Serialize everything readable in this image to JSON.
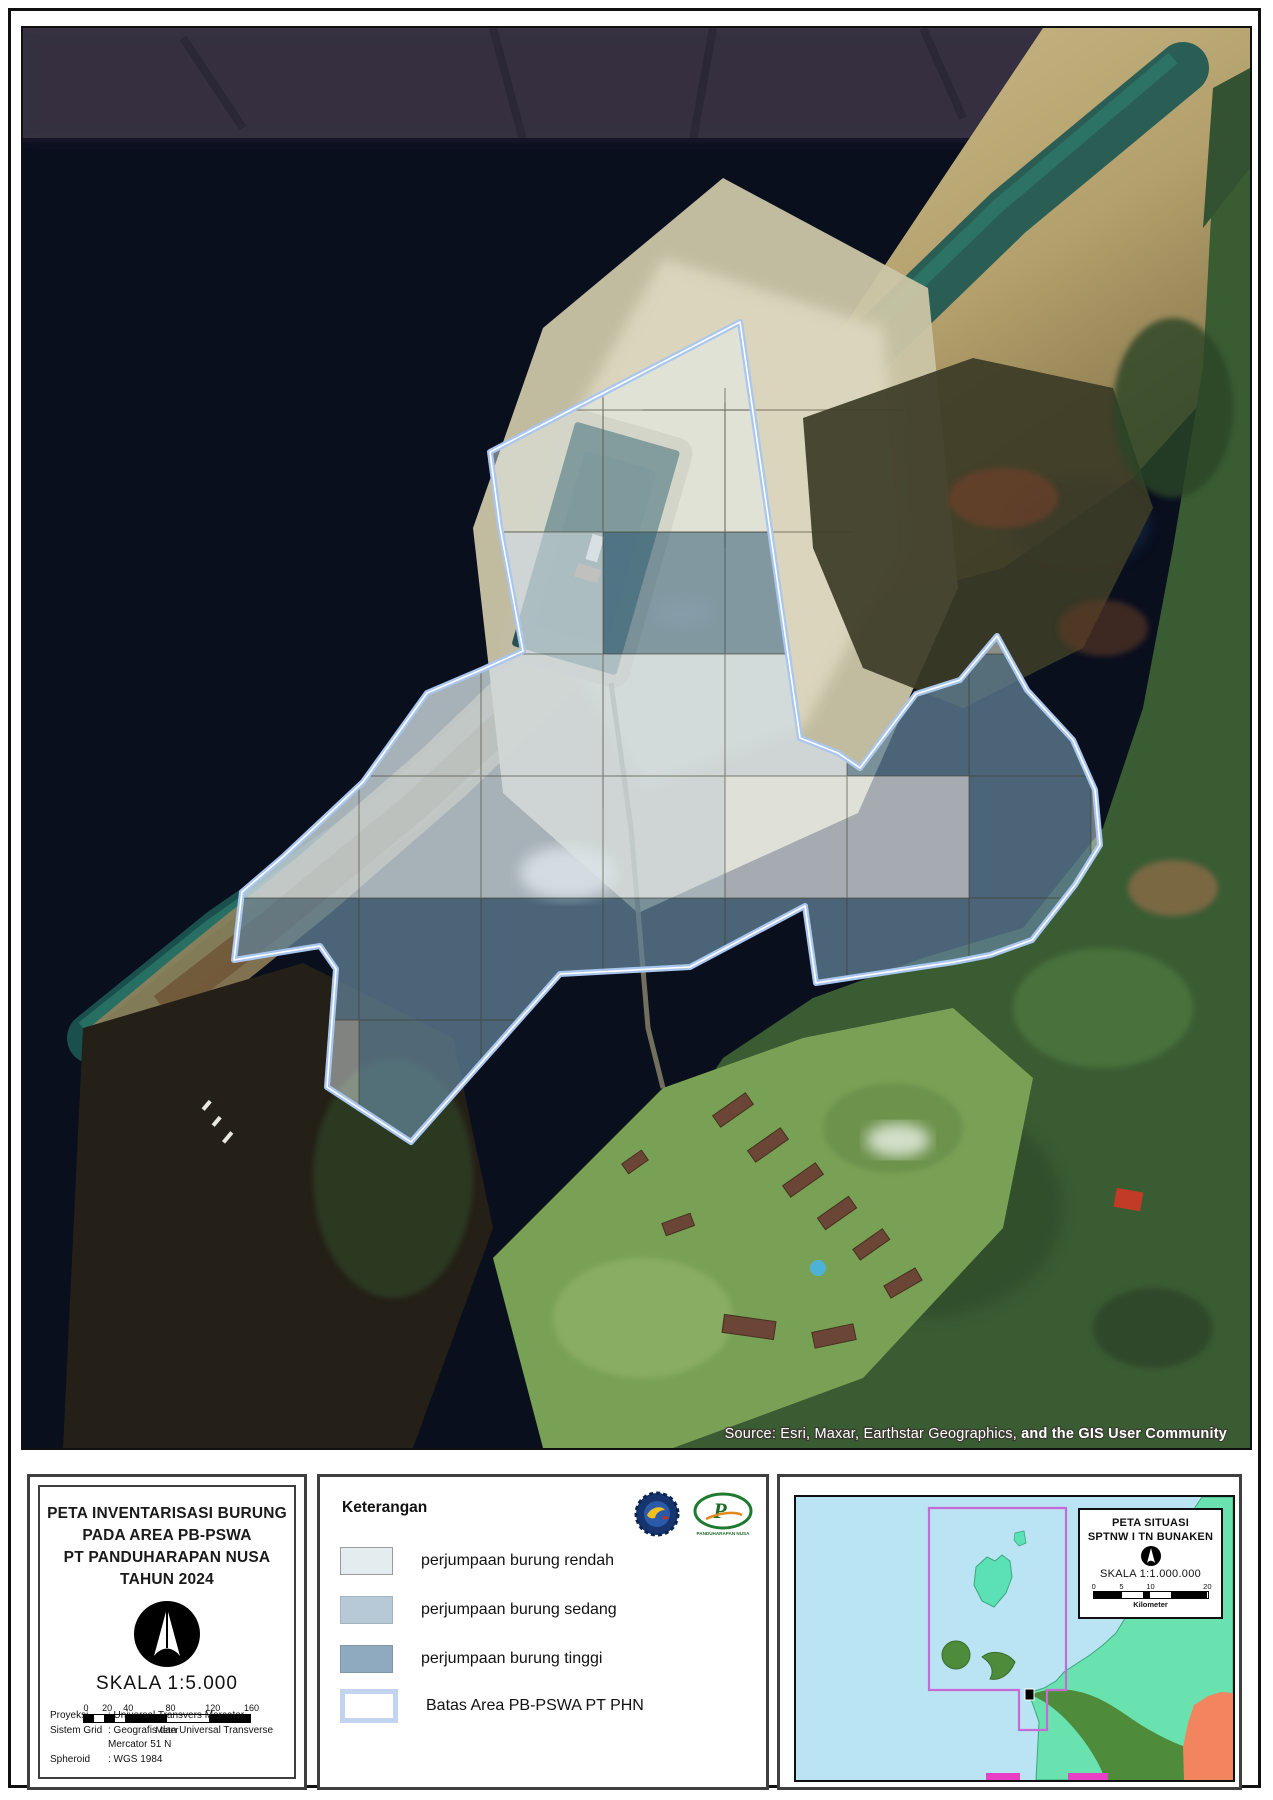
{
  "map": {
    "source_attribution": {
      "regular": "Source: Esri, Maxar, Earthstar Geographics, ",
      "bold": "and the GIS User Community"
    },
    "overlay": {
      "boundary_color": "#a9c6ee",
      "levels": {
        "rendah": {
          "fill": "#f0f5f6",
          "opacity": 0.4
        },
        "sedang": {
          "fill": "#c9d6dc",
          "opacity": 0.6
        },
        "tinggi": {
          "fill": "#214d6b",
          "opacity": 0.5
        }
      },
      "grid_cells": [
        {
          "col": 2,
          "row": 1,
          "level": "sedang"
        },
        {
          "col": 3,
          "row": 1,
          "level": "tinggi"
        },
        {
          "col": 4,
          "row": 1,
          "level": "tinggi"
        },
        {
          "col": 0,
          "row": 2,
          "level": "sedang"
        },
        {
          "col": 1,
          "row": 2,
          "level": "sedang"
        },
        {
          "col": 2,
          "row": 2,
          "level": "sedang"
        },
        {
          "col": 3,
          "row": 2,
          "level": "sedang"
        },
        {
          "col": 4,
          "row": 2,
          "level": "sedang"
        },
        {
          "col": 5,
          "row": 2,
          "level": "tinggi"
        },
        {
          "col": 6,
          "row": 2,
          "level": "tinggi"
        },
        {
          "col": 0,
          "row": 3,
          "level": "sedang"
        },
        {
          "col": 1,
          "row": 3,
          "level": "sedang"
        },
        {
          "col": 2,
          "row": 3,
          "level": "sedang"
        },
        {
          "col": 3,
          "row": 3,
          "level": "sedang"
        },
        {
          "col": 4,
          "row": 3,
          "level": "rendah"
        },
        {
          "col": 5,
          "row": 3,
          "level": "rendah"
        },
        {
          "col": 6,
          "row": 3,
          "level": "tinggi"
        },
        {
          "col": 0,
          "row": 4,
          "level": "tinggi"
        },
        {
          "col": 1,
          "row": 4,
          "level": "tinggi"
        },
        {
          "col": 2,
          "row": 4,
          "level": "tinggi"
        },
        {
          "col": 3,
          "row": 4,
          "level": "tinggi"
        },
        {
          "col": 4,
          "row": 4,
          "level": "tinggi"
        },
        {
          "col": 5,
          "row": 4,
          "level": "tinggi"
        },
        {
          "col": 6,
          "row": 4,
          "level": "tinggi"
        },
        {
          "col": 1,
          "row": 5,
          "level": "tinggi"
        },
        {
          "col": 2,
          "row": 5,
          "level": "tinggi"
        }
      ]
    }
  },
  "title_block": {
    "title_lines": [
      "PETA INVENTARISASI BURUNG",
      "PADA AREA PB-PSWA",
      "PT PANDUHARAPAN NUSA",
      "TAHUN 2024"
    ],
    "scale_label": "SKALA 1:5.000",
    "scale_bar": {
      "ticks": [
        "0",
        "20",
        "40",
        "80",
        "120",
        "160"
      ],
      "unit": "Meter"
    },
    "projection_rows": [
      {
        "label": "Proyeksi",
        "value": ": Universal Transvers Mercator"
      },
      {
        "label": "Sistem Grid",
        "value": ": Geografis dan Universal Transverse Mercator 51 N"
      },
      {
        "label": "Spheroid",
        "value": ": WGS 1984"
      }
    ]
  },
  "legend": {
    "title": "Keterangan",
    "items": [
      {
        "label": "perjumpaan burung rendah",
        "color": "#e3edef",
        "border": "#9a9a9a"
      },
      {
        "label": "perjumpaan burung sedang",
        "color": "#b7c9d6",
        "border": "#a5b3bd"
      },
      {
        "label": "perjumpaan burung tinggi",
        "color": "#8fa9bf",
        "border": "#8096a9"
      },
      {
        "label": "Batas Area PB-PSWA PT PHN",
        "color": "#ffffff",
        "border": "#c3d4f0"
      }
    ],
    "logos": [
      {
        "name": "tn-bunaken-logo"
      },
      {
        "name": "pt-phn-logo",
        "caption": "PANDUHARAPAN NUSA"
      }
    ]
  },
  "inset": {
    "title_lines": [
      "PETA SITUASI",
      "SPTNW I TN BUNAKEN"
    ],
    "scale_label": "SKALA 1:1.000.000",
    "scale_bar": {
      "ticks": [
        "0",
        "5",
        "10",
        "20"
      ],
      "unit": "Kilometer"
    }
  }
}
